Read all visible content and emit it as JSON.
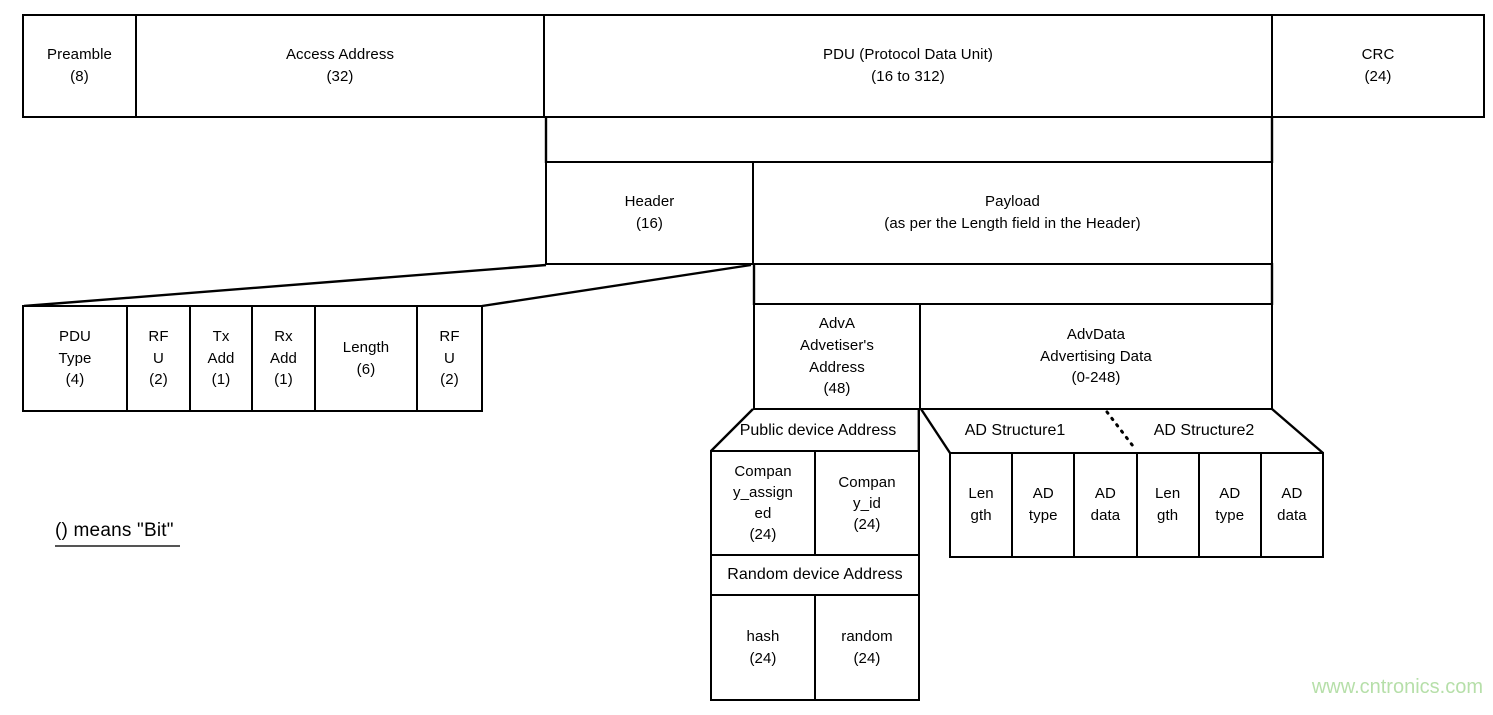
{
  "packet": {
    "preamble": "Preamble\n(8)",
    "access_address": "Access Address\n(32)",
    "pdu": "PDU (Protocol Data Unit)\n(16 to 312)",
    "crc": "CRC\n(24)"
  },
  "pdu_breakdown": {
    "header": "Header\n(16)",
    "payload": "Payload\n(as per the Length field in the Header)"
  },
  "header_fields": [
    "PDU\nType\n(4)",
    "RF\nU\n(2)",
    "Tx\nAdd\n(1)",
    "Rx\nAdd\n(1)",
    "Length\n(6)",
    "RF\nU\n(2)"
  ],
  "payload_breakdown": {
    "adva": "AdvA\nAdvetiser's\nAddress\n(48)",
    "advdata": "AdvData\nAdvertising Data\n(0-248)"
  },
  "adva_breakdown": {
    "public_header": "Public device Address",
    "company_assigned": "Compan\ny_assign\ned\n(24)",
    "company_id": "Compan\ny_id\n(24)",
    "random_header": "Random device Address",
    "hash": "hash\n(24)",
    "random": "random\n(24)"
  },
  "advdata_breakdown": {
    "structure1": "AD Structure1",
    "structure2": "AD Structure2",
    "fields": [
      "Len\ngth",
      "AD\ntype",
      "AD\ndata",
      "Len\ngth",
      "AD\ntype",
      "AD\ndata"
    ]
  },
  "legend": "() means \"Bit\"",
  "watermark": "www.cntronics.com",
  "colors": {
    "line": "#000000",
    "background": "#ffffff",
    "watermark_green": "#b6dfa9"
  }
}
